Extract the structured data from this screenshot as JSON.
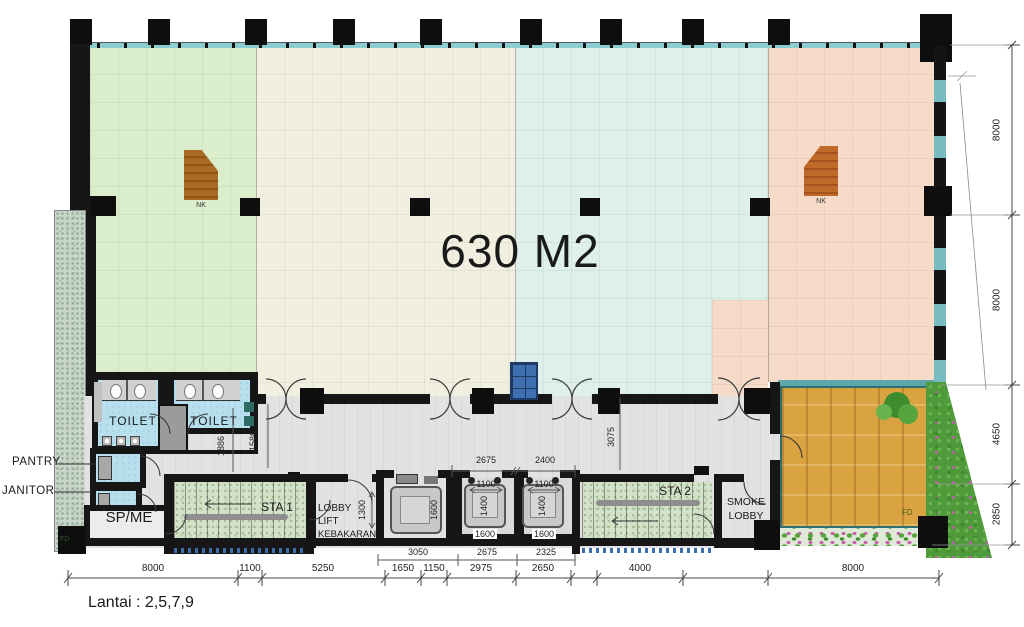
{
  "plan": {
    "area_label": "630 M2",
    "floor_note": "Lantai : 2,5,7,9",
    "rooms": {
      "toilet_left": "TOILET",
      "toilet_right": "TOILET",
      "pantry": "PANTRY",
      "janitor": "JANITOR",
      "sp_me": "SP/ME",
      "sta_1": "STA 1",
      "sta_2": "STA 2",
      "smoke_lobby": [
        "SMOKE",
        "LOBBY"
      ],
      "fire_lift_lobby": [
        "LOBBY",
        "LIFT",
        "KEBAKARAN"
      ]
    },
    "markers": {
      "nk_left": "NK",
      "nk_right": "NK",
      "fd_left": "FD",
      "fd_deck": "FD"
    },
    "dims": {
      "bottom": [
        "8000",
        "1100",
        "5250",
        "1650",
        "1150",
        "2975",
        "2650",
        "4000",
        "8000"
      ],
      "right": [
        "8000",
        "8000",
        "4650",
        "2850"
      ],
      "interior": {
        "toilet_corridor_a": "1886",
        "toilet_corridor_b": "1586",
        "corridor_right": "3075",
        "lift_shaft_top": [
          "2675",
          "2400"
        ],
        "lift_door": [
          "1100",
          "1100"
        ],
        "fire_lobby_depth": "1300",
        "fire_lift_car_depth": "1600",
        "lift_car_depth": [
          "1400",
          "1400"
        ],
        "lift_car_width": [
          "1600",
          "1600"
        ],
        "lift_bottom": [
          "3050",
          "2675",
          "2325"
        ]
      }
    },
    "colors": {
      "zone_green": "#daeecb",
      "zone_cream": "#f1efe0",
      "zone_blue": "#dff0eb",
      "zone_pink": "#f6dcc8",
      "deck_wood": "#d9a342",
      "grass": "#4f9a3a",
      "toilet_floor": "#b8dfee",
      "stair_green": "#d3e2c8",
      "wall": "#161616"
    }
  }
}
